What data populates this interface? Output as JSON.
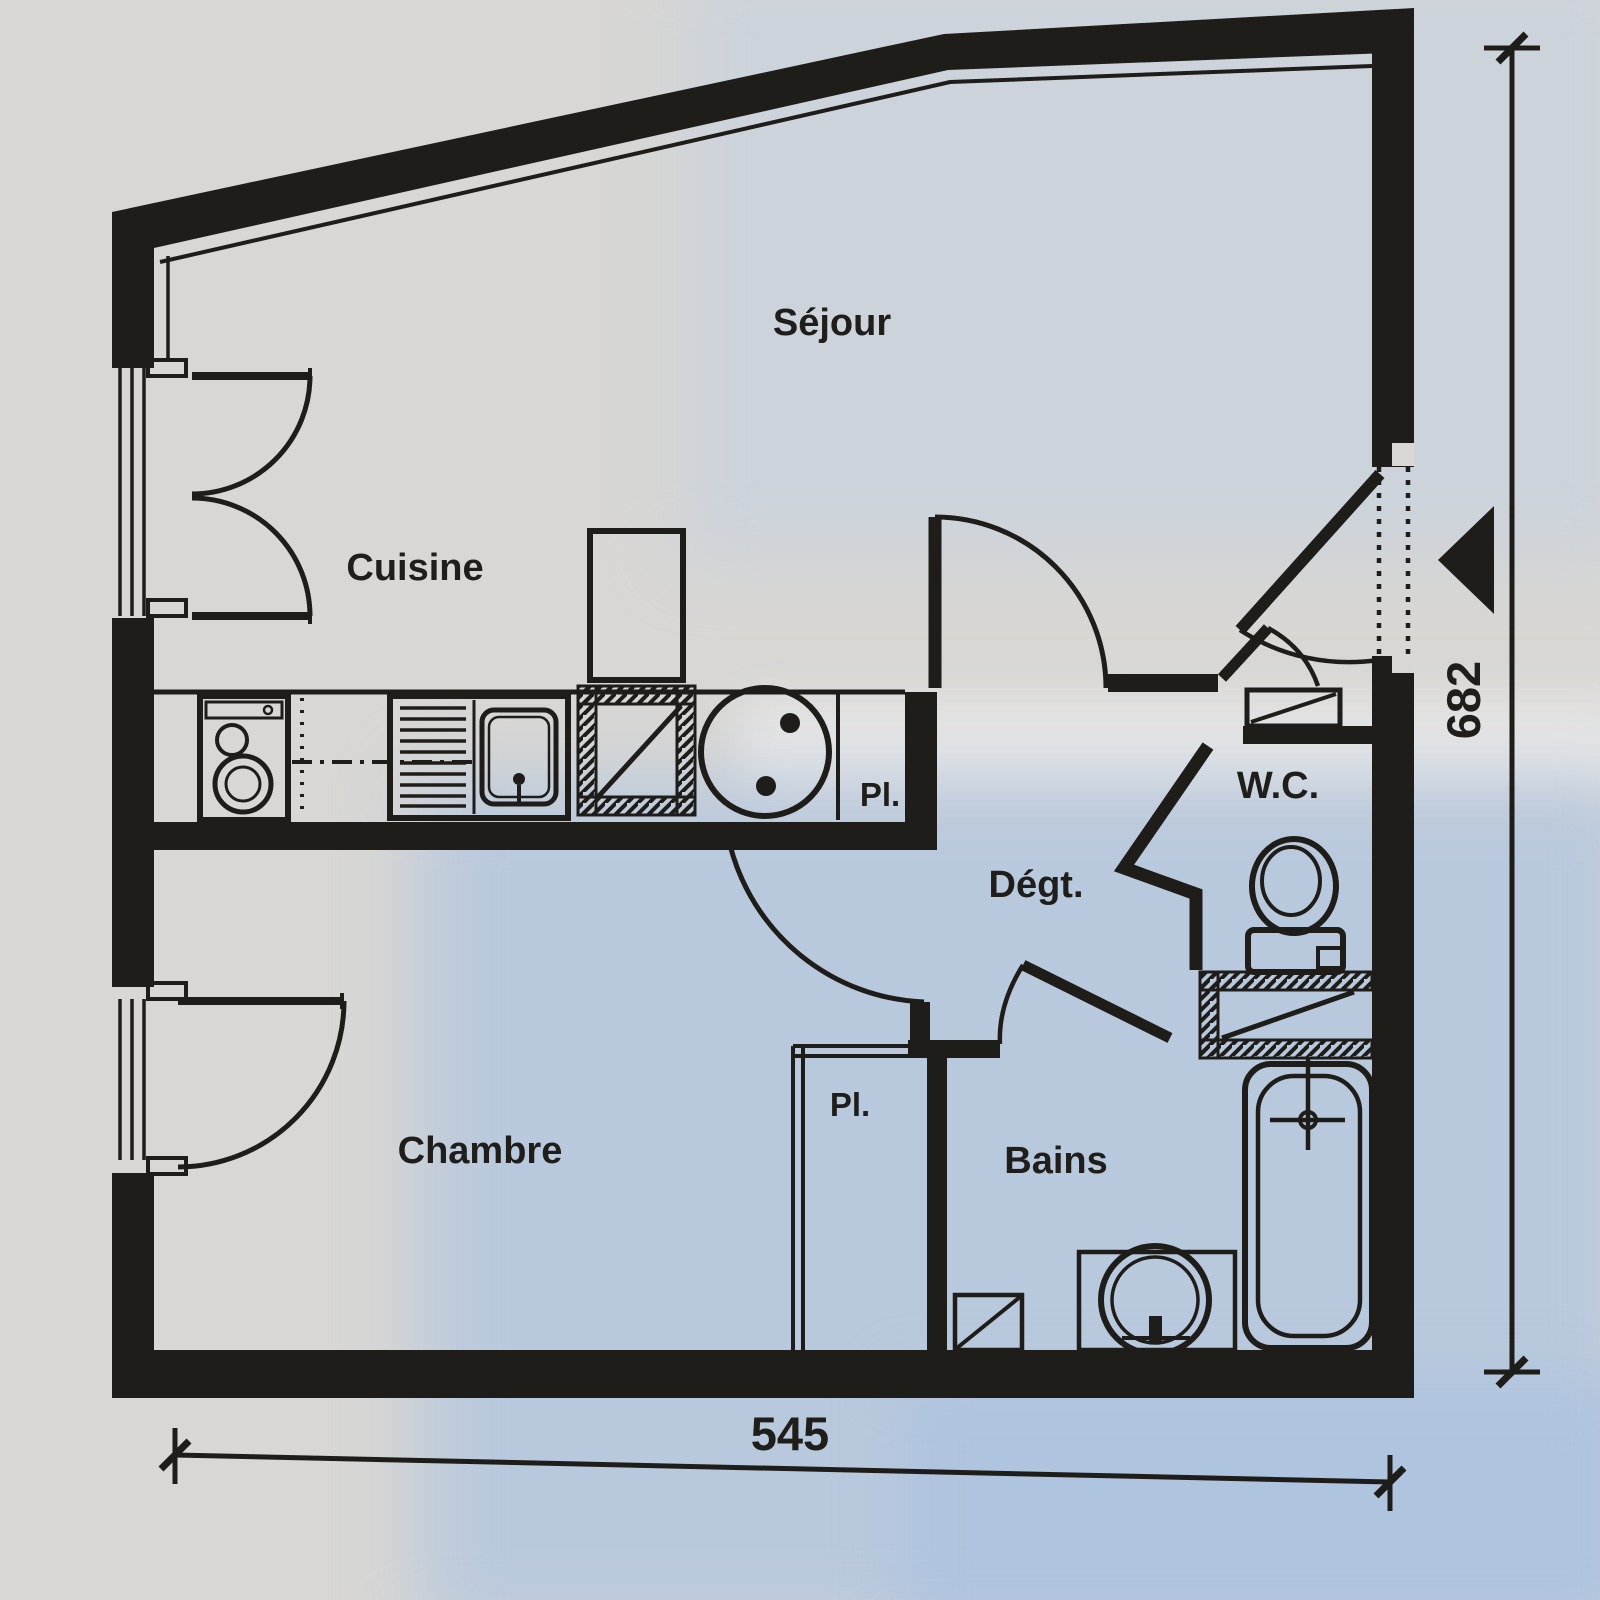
{
  "document": {
    "kind": "apartment floor plan (scanned drawing)",
    "colors": {
      "ink": "#1f1d1a",
      "paper": "#d8d7d4",
      "paper_blue_tint": "#bccbe2"
    }
  },
  "rooms": {
    "sejour": {
      "label": "Séjour"
    },
    "cuisine": {
      "label": "Cuisine"
    },
    "chambre": {
      "label": "Chambre"
    },
    "degagement": {
      "label": "Dégt."
    },
    "wc": {
      "label": "W.C."
    },
    "bains": {
      "label": "Bains"
    },
    "placard_cuisine": {
      "label": "Pl."
    },
    "placard_chambre": {
      "label": "Pl."
    }
  },
  "dimensions": {
    "bottom_width": {
      "value": "545"
    },
    "right_height": {
      "value": "682"
    }
  }
}
